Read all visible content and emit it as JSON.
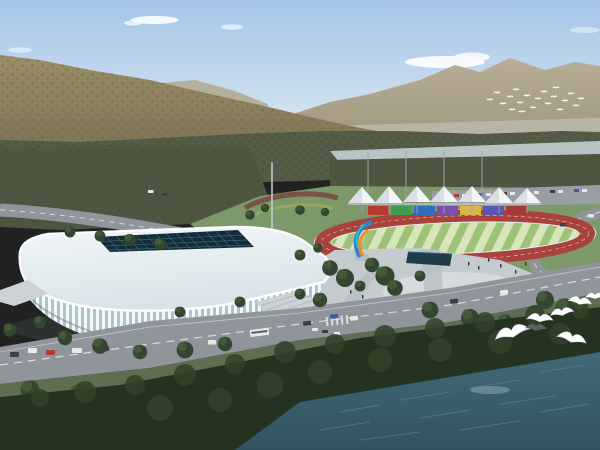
{
  "scene": {
    "title": "Aerial architectural rendering of a sports-park: white ribbed arena, athletics track with rainbow canopies, plaza with sculpture, mountains behind, lake in front",
    "type": "architectural-rendering"
  },
  "colors": {
    "sky_top": "#a3c4e7",
    "sky_mid": "#cfe0ef",
    "sky_horizon": "#e9edf0",
    "cloud": "#ffffff",
    "mountain_far_top": "#b8ae96",
    "mountain_far_bottom": "#98907b",
    "ridge_haze": "#b2a88f",
    "mountain_left_top": "#9b8e67",
    "mountain_left_bottom": "#7b7355",
    "mountain_dots": "#6d6648",
    "valley_trees": "#545b46",
    "valley_trees_dark": "#454e38",
    "left_forest": "#4e5540",
    "river": "#b6c5c3",
    "park_grass": "#7d996a",
    "parking": "#989ea3",
    "track_red": "#a8423a",
    "track_curb": "#e8eaec",
    "infield_green": "#9fc27a",
    "infield_stripe": "#d6e6b8",
    "tent_white": "#f3f5f7",
    "tent_shade": "#d9dde1",
    "truss": "#c8ccd0",
    "plaza": "#c6cbcf",
    "plaza_light": "#d6dadd",
    "pool": "#203c47",
    "stadium_roof_light": "#f1f6f8",
    "stadium_roof_shade": "#d9e3e8",
    "skylight": "#142c38",
    "skylight_grid": "#3f6a7a",
    "facade_glass": "#a9c6ca",
    "facade_rib": "#f4f8fa",
    "entrance": "#ccd1d5",
    "road": "#8f959b",
    "road_line": "#e8eaec",
    "grass_near": "#5e6e50",
    "tree_dark": "#33462f",
    "tree_light": "#49603f",
    "shore_forest": "#243220",
    "shore_forest_hi": "#31422a",
    "water_deep": "#33525f",
    "water_light": "#406a77",
    "ripple": "#5d8894",
    "sculpture_blue": "#2b84d6",
    "sculpture_orange": "#e8912a",
    "sculpture_teal": "#35b8c8",
    "pedestal": "#b9bec2",
    "people": "#2e3438",
    "vehicle_white": "#e6e9eb",
    "vehicle_dark": "#3a4147",
    "vehicle_red": "#b03a32",
    "vehicle_blue": "#3d5f9e",
    "pole": "#9aa2a8",
    "bird_white": "#ffffff",
    "bird_dark": "#5a6360",
    "shadow": "#4a5a4c"
  },
  "track": {
    "blocks": [
      "#b23b30",
      "#3f9e4d",
      "#2f6fbe",
      "#7a4fae",
      "#d9b64a",
      "#5c55b8",
      "#a83a32"
    ],
    "tent_count": 7
  },
  "wildlife": {
    "small_flock_count": 20,
    "gull_count": 7
  }
}
